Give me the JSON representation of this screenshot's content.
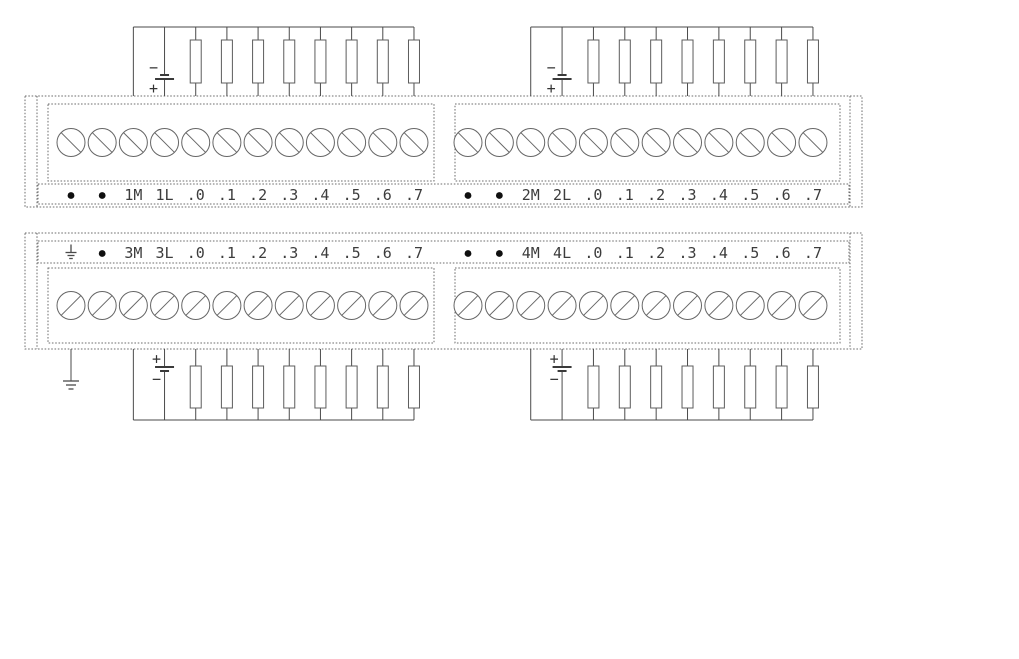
{
  "diagram": {
    "kind": "plc-io-module-terminal-wiring",
    "background": "#ffffff",
    "line_color": "#4a4a4a",
    "text_color": "#3c3c3c",
    "blocks": [
      {
        "id": "upper-terminal-block",
        "loads_position": "above",
        "groups": [
          {
            "id": "group-1",
            "labels": [
              "•",
              "•",
              "1M",
              "1L",
              ".0",
              ".1",
              ".2",
              ".3",
              ".4",
              ".5",
              ".6",
              ".7"
            ],
            "power_top_sign": "−",
            "power_bottom_sign": "+",
            "has_ground_lead": false,
            "load_count": 8
          },
          {
            "id": "group-2",
            "labels": [
              "•",
              "•",
              "2M",
              "2L",
              ".0",
              ".1",
              ".2",
              ".3",
              ".4",
              ".5",
              ".6",
              ".7"
            ],
            "power_top_sign": "−",
            "power_bottom_sign": "+",
            "has_ground_lead": false,
            "load_count": 8
          }
        ]
      },
      {
        "id": "lower-terminal-block",
        "loads_position": "below",
        "groups": [
          {
            "id": "group-3",
            "labels": [
              "⏚",
              "•",
              "3M",
              "3L",
              ".0",
              ".1",
              ".2",
              ".3",
              ".4",
              ".5",
              ".6",
              ".7"
            ],
            "power_top_sign": "+",
            "power_bottom_sign": "−",
            "has_ground_lead": true,
            "load_count": 8
          },
          {
            "id": "group-4",
            "labels": [
              "•",
              "•",
              "4M",
              "4L",
              ".0",
              ".1",
              ".2",
              ".3",
              ".4",
              ".5",
              ".6",
              ".7"
            ],
            "power_top_sign": "+",
            "power_bottom_sign": "−",
            "has_ground_lead": false,
            "load_count": 8
          }
        ]
      }
    ]
  }
}
